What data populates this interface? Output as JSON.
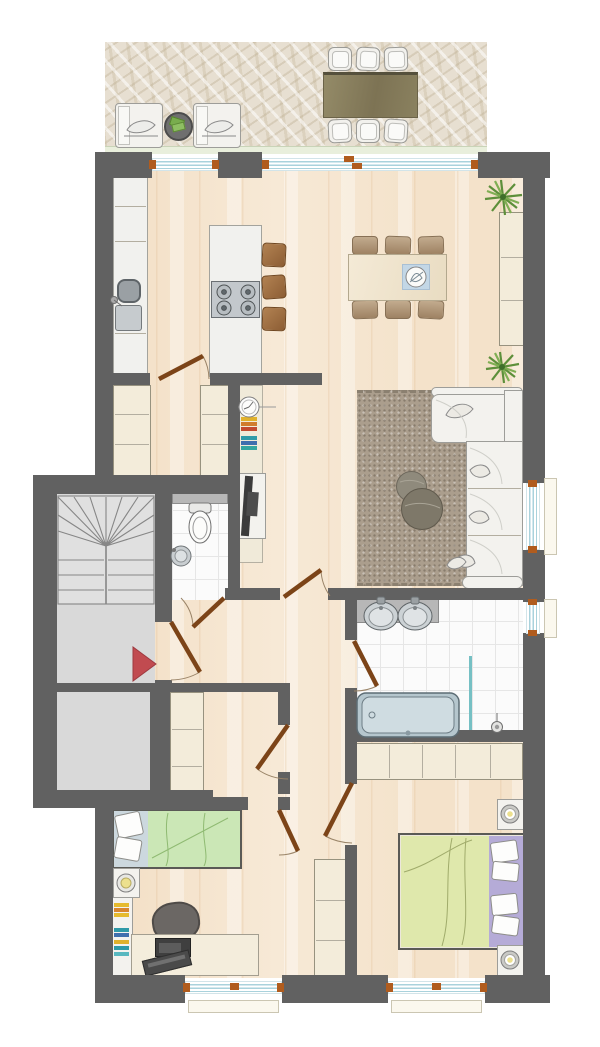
{
  "plan": {
    "kind": "apartment-floor-plan",
    "orientation": "top-down",
    "rooms": [
      {
        "id": "terrace",
        "label": "terrace",
        "furniture": [
          "lounger",
          "lounger",
          "side-table",
          "outdoor-dining-table",
          "6 outdoor chairs"
        ]
      },
      {
        "id": "kitchen",
        "label": "kitchen",
        "furniture": [
          "counter-with-sink",
          "island-with-cooktop",
          "3 bar stools"
        ]
      },
      {
        "id": "dining",
        "label": "dining-area",
        "furniture": [
          "dining-table",
          "6 chairs",
          "place-setting",
          "sideboard",
          "2 plants"
        ]
      },
      {
        "id": "living",
        "label": "living-area",
        "furniture": [
          "corner-sofa",
          "2 round coffee-tables",
          "rug",
          "tv-board with tv"
        ]
      },
      {
        "id": "storage",
        "label": "storage-room",
        "furniture": [
          "wardrobe",
          "wardrobe"
        ]
      },
      {
        "id": "wc",
        "label": "guest-wc",
        "furniture": [
          "toilet",
          "washbasin",
          "counter"
        ]
      },
      {
        "id": "hallway",
        "label": "hallway",
        "furniture": [
          "shelf",
          "wall-clock",
          "books"
        ]
      },
      {
        "id": "stairwell",
        "label": "stairwell",
        "furniture": [
          "stairs",
          "entrance-marker"
        ]
      },
      {
        "id": "bathroom",
        "label": "bathroom",
        "furniture": [
          "double-washbasin",
          "bathtub",
          "shower-glass",
          "shower-head"
        ]
      },
      {
        "id": "closet",
        "label": "walk-in-closet",
        "furniture": [
          "wardrobe"
        ]
      },
      {
        "id": "bedroom-left",
        "label": "bedroom-left",
        "furniture": [
          "single-bed",
          "nightstand-with-lamp",
          "bookshelf",
          "desk",
          "office-chair",
          "keyboard",
          "laptop",
          "wardrobe"
        ]
      },
      {
        "id": "bedroom-right",
        "label": "bedroom-right",
        "furniture": [
          "double-bed",
          "2 nightstands-with-lamps",
          "wardrobe"
        ]
      }
    ],
    "entrance_marker": {
      "shape": "triangle",
      "direction": "right"
    },
    "window_count": 6,
    "door_count": 8
  },
  "colors": {
    "wall": "#616161",
    "floor_wood": "#f7e9d6",
    "terrace_stone": "#e7dfd1",
    "stair_floor": "#d9d9d9",
    "tile": "#fbfbfb",
    "tile_line": "#e6e6e6",
    "glass": "#a9d2dc",
    "frame": "#b05c1e",
    "door": "#7c4418",
    "rug": "#ab9e8d",
    "sofa_white": "#f3f2ee",
    "unit_cream": "#f3ecda",
    "table_wood": "#8c8263",
    "stool_brown": "#a5764a",
    "bed_green_left": "#cbe7b6",
    "bed_green_right": "#dfe8ac",
    "bed_purple": "#b5abd7",
    "lamp_yellow": "#ece08e",
    "plant_green": "#5d8f3a",
    "marker_red": "#c14b50",
    "counter_gray": "#b7b7b7",
    "appliance_gray": "#c3c8cc",
    "tub_blue": "#cfdce1"
  }
}
